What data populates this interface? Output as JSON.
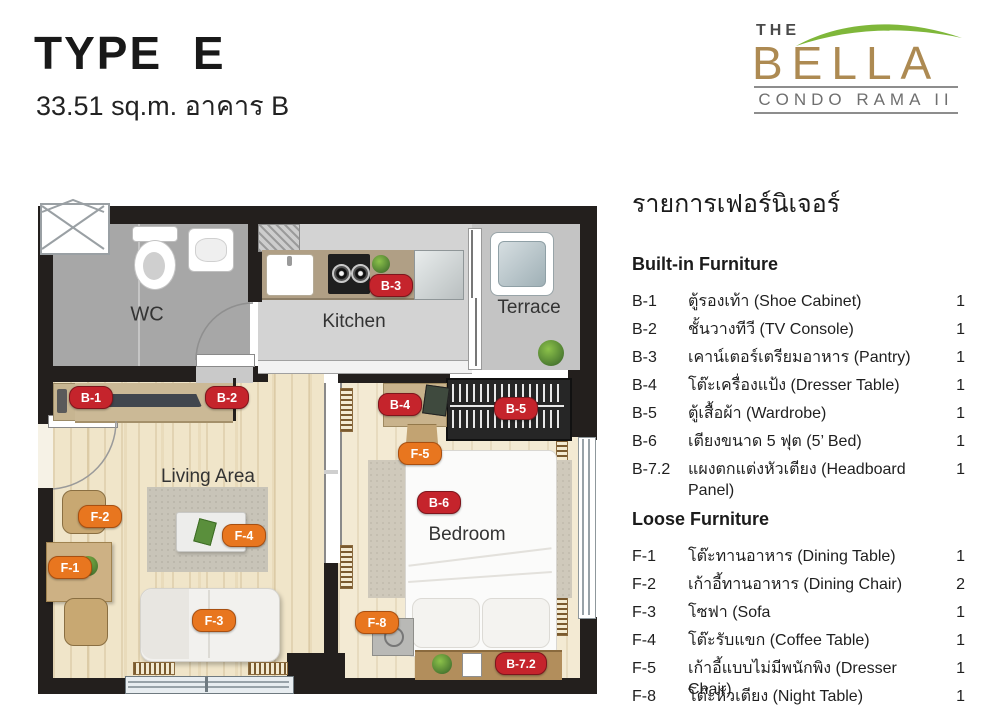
{
  "theme": {
    "badge_red": "#c5242c",
    "badge_orange": "#e8761f",
    "wall_black": "#231f1d",
    "logo_green": "#7fb73a",
    "logo_brown": "#ad8a52",
    "logo_gray": "#6f6f6f"
  },
  "header": {
    "title": "TYPE E",
    "subtitle": "33.51 sq.m. อาคาร B"
  },
  "logo": {
    "the": "THE",
    "name": "BELLA",
    "tagline": "CONDO RAMA II"
  },
  "furniture": {
    "title": "รายการเฟอร์นิเจอร์",
    "builtin": {
      "heading": "Built-in Furniture",
      "items": [
        {
          "code": "B-1",
          "name": "ตู้รองเท้า (Shoe Cabinet)",
          "qty": "1"
        },
        {
          "code": "B-2",
          "name": "ชั้นวางทีวี (TV Console)",
          "qty": "1"
        },
        {
          "code": "B-3",
          "name": "เคาน์เตอร์เตรียมอาหาร (Pantry)",
          "qty": "1"
        },
        {
          "code": "B-4",
          "name": "โต๊ะเครื่องแป้ง (Dresser Table)",
          "qty": "1"
        },
        {
          "code": "B-5",
          "name": "ตู้เสื้อผ้า (Wardrobe)",
          "qty": "1"
        },
        {
          "code": "B-6",
          "name": "เตียงขนาด 5 ฟุต (5’ Bed)",
          "qty": "1"
        },
        {
          "code": "B-7.2",
          "name": "แผงตกแต่งหัวเตียง (Headboard Panel)",
          "qty": "1"
        }
      ]
    },
    "loose": {
      "heading": "Loose Furniture",
      "items": [
        {
          "code": "F-1",
          "name": "โต๊ะทานอาหาร (Dining Table)",
          "qty": "1"
        },
        {
          "code": "F-2",
          "name": "เก้าอี้ทานอาหาร (Dining Chair)",
          "qty": "2"
        },
        {
          "code": "F-3",
          "name": "โซฟา (Sofa",
          "qty": "1"
        },
        {
          "code": "F-4",
          "name": "โต๊ะรับแขก (Coffee Table)",
          "qty": "1"
        },
        {
          "code": "F-5",
          "name": "เก้าอี้แบบไม่มีพนักพิง (Dresser Chair)",
          "qty": "1"
        },
        {
          "code": "F-8",
          "name": "โต๊ะหัวเตียง (Night Table)",
          "qty": "1"
        }
      ]
    }
  },
  "plan": {
    "rooms": {
      "wc": "WC",
      "kitchen": "Kitchen",
      "terrace": "Terrace",
      "living": "Living Area",
      "bedroom": "Bedroom"
    },
    "badges": [
      {
        "code": "B-1"
      },
      {
        "code": "B-2"
      },
      {
        "code": "B-3"
      },
      {
        "code": "B-4"
      },
      {
        "code": "B-5"
      },
      {
        "code": "F-5"
      },
      {
        "code": "B-6"
      },
      {
        "code": "F-2"
      },
      {
        "code": "F-4"
      },
      {
        "code": "F-1"
      },
      {
        "code": "F-3"
      },
      {
        "code": "F-8"
      },
      {
        "code": "B-7.2"
      }
    ]
  }
}
